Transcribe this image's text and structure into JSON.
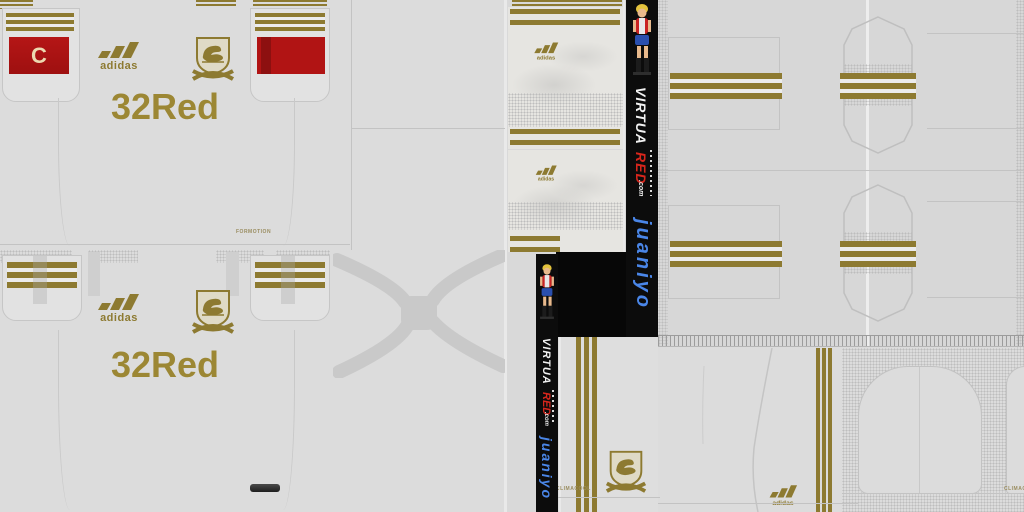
{
  "sheet": {
    "shirt1": {
      "captain_badge": "C",
      "sponsor": "32Red",
      "tech_label": "FORMOTION"
    },
    "shirt2": {
      "sponsor": "32Red"
    },
    "brand": {
      "wordmark": "adidas"
    },
    "banner": {
      "brand_main": "VIRTUA",
      "brand_accent": "RED",
      "brand_suffix": ".com",
      "author": "juaniyo"
    },
    "socks": {
      "tech_label": "CLIMACOOL",
      "tech_label_clipped": "CLIMAC"
    },
    "icons": {
      "adidas_logo": "adidas-three-bars-logo",
      "club_crest": "swan-shield-crest",
      "mascot": "virtuared-mascot-figure"
    },
    "colors": {
      "base_grey": "#dcdcdc",
      "stripe_gold": "#8d7a31",
      "sponsor_gold": "#9c8734",
      "captain_red": "#b11414",
      "banner_black": "#0c0c0c",
      "accent_red": "#d8261c",
      "author_blue": "#4a86e8"
    }
  }
}
